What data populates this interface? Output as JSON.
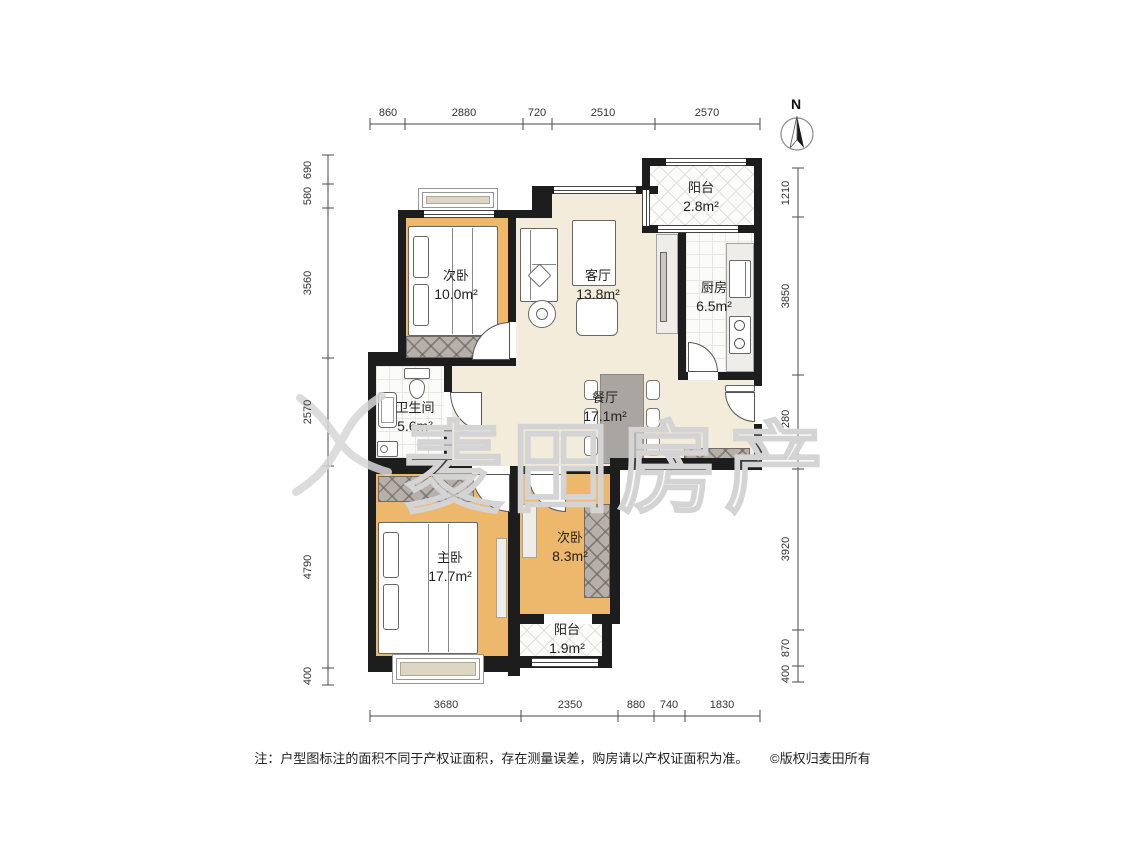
{
  "north_label": "N",
  "watermark_text": "麦田房产",
  "rooms": {
    "bedroom_top": {
      "name": "次卧",
      "area": "10.0m²"
    },
    "living": {
      "name": "客厅",
      "area": "13.8m²"
    },
    "balcony_top": {
      "name": "阳台",
      "area": "2.8m²"
    },
    "kitchen": {
      "name": "厨房",
      "area": "6.5m²"
    },
    "bathroom": {
      "name": "卫生间",
      "area": "5.6m²"
    },
    "dining": {
      "name": "餐厅",
      "area": "17.1m²"
    },
    "master": {
      "name": "主卧",
      "area": "17.7m²"
    },
    "bedroom_bottom": {
      "name": "次卧",
      "area": "8.3m²"
    },
    "balcony_bottom": {
      "name": "阳台",
      "area": "1.9m²"
    }
  },
  "dims": {
    "top": [
      "860",
      "2880",
      "720",
      "2510",
      "2570"
    ],
    "bottom": [
      "3680",
      "2350",
      "880",
      "740",
      "1830"
    ],
    "left": [
      "690",
      "580",
      "3560",
      "2570",
      "4790",
      "400"
    ],
    "right": [
      "1210",
      "3850",
      "2280",
      "3920",
      "870",
      "400"
    ]
  },
  "footer": {
    "note": "注：户型图标注的面积不同于产权证面积，存在测量误差，购房请以产权证面积为准。",
    "copyright": "©版权归麦田所有"
  },
  "colors": {
    "wall": "#1d1d1d",
    "bedroom_floor": "#eeb86c",
    "living_floor": "#f4ecda",
    "watermark": "#d4d4d4"
  }
}
